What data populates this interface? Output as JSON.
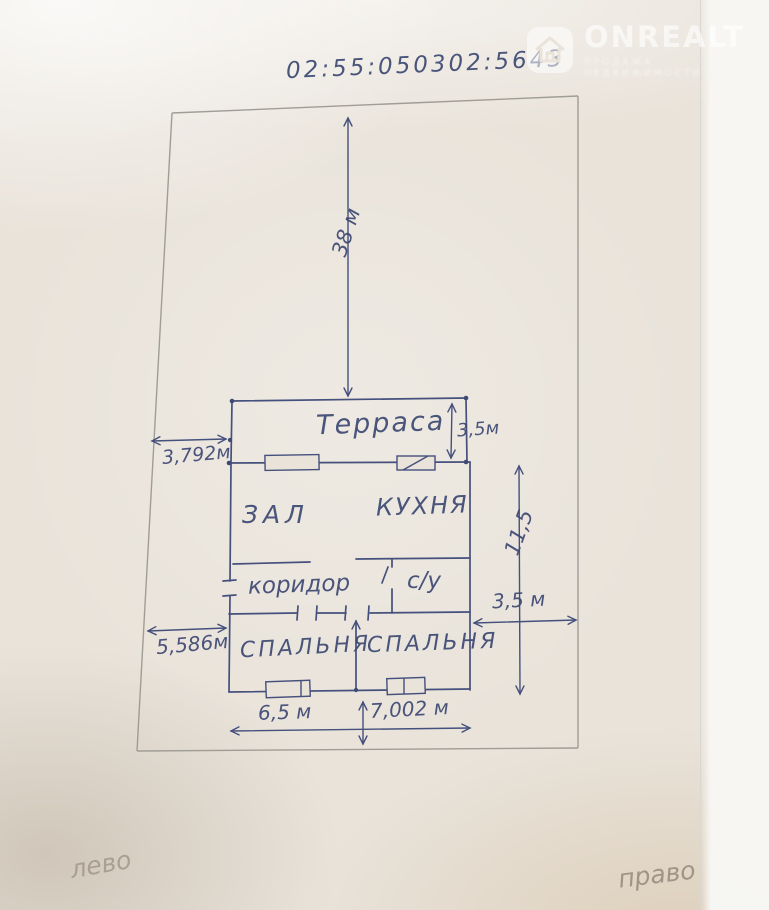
{
  "watermark": {
    "brand": "ONREALT",
    "subtitle": "ПРОДАЖА НЕДВИЖИМОСТИ",
    "icon": "house-icon",
    "color": "#ffffff"
  },
  "cadastral_number": "02:55:050302:5643",
  "plan": {
    "rooms": [
      {
        "label": "Терраса"
      },
      {
        "label": "ЗАЛ"
      },
      {
        "label": "КУХНЯ"
      },
      {
        "label": "коридор"
      },
      {
        "label": "с/у"
      },
      {
        "label": "СПАЛЬНЯ"
      },
      {
        "label": "СПАЛЬНЯ"
      }
    ],
    "dimensions": {
      "plot_depth": "38 м",
      "terrace_depth": "3,5м",
      "offset_left_top": "3,792м",
      "house_depth": "11,5",
      "offset_right": "3,5 м",
      "offset_left_bottom": "5,586м",
      "house_width_left": "6,5 м",
      "house_width_total": "7,002 м"
    }
  },
  "notes": {
    "bottom_left": "лево",
    "bottom_right": "право"
  },
  "colors": {
    "ink": "#3e4a74",
    "boundary_pencil": "#a09d96",
    "paper": "#e9e3da",
    "note_pencil": "#a2988a"
  }
}
